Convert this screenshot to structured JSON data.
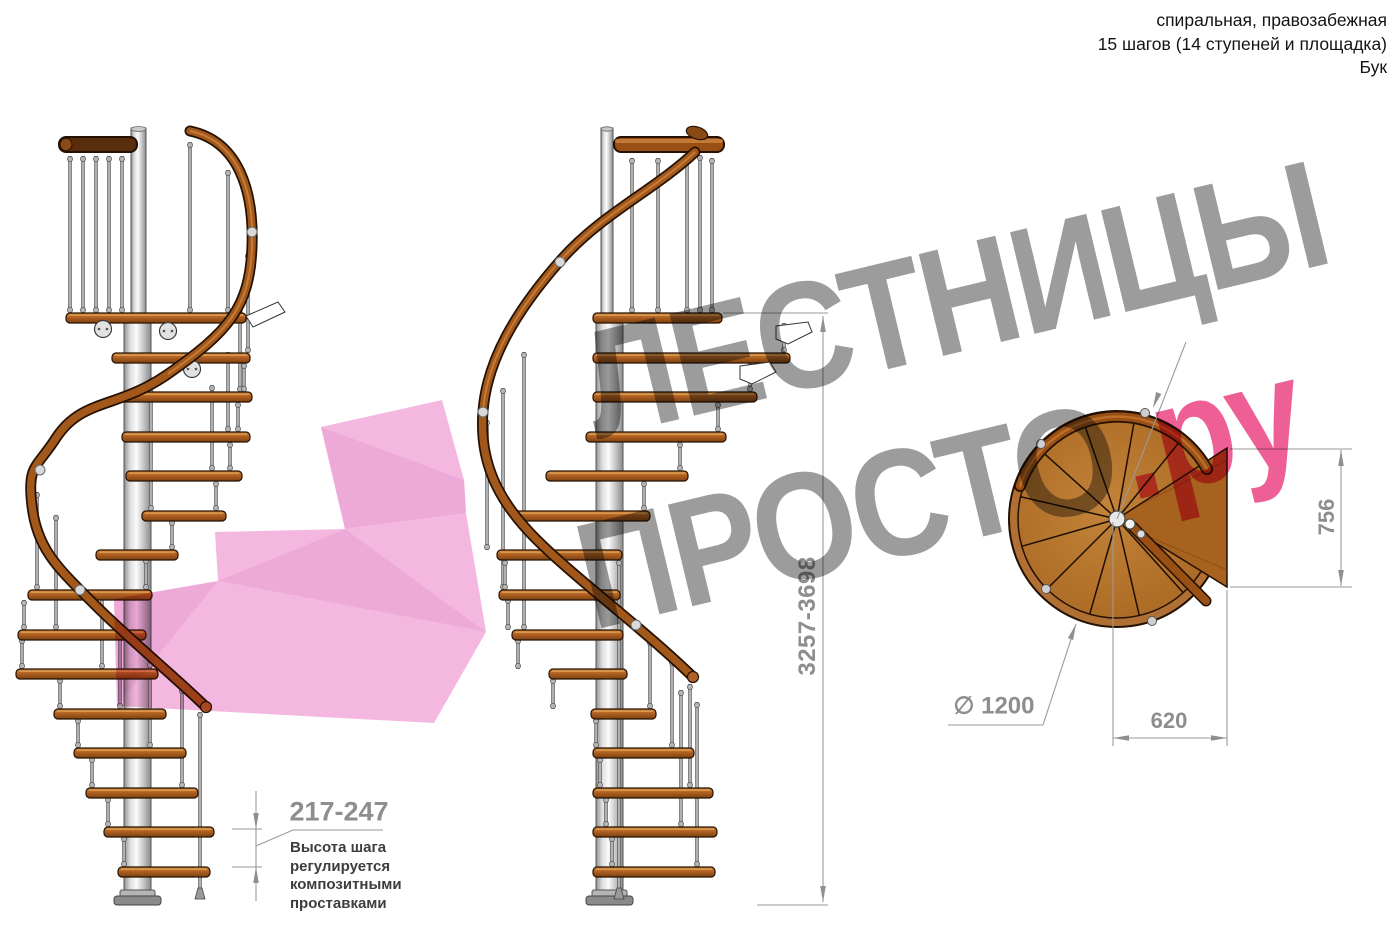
{
  "title_block": {
    "lines": [
      "спиральная, правозабежная",
      "15 шагов (14 ступеней и площадка)",
      "Бук"
    ]
  },
  "watermark": {
    "word1": "ЛЕСТНИЦЫ",
    "word2": "ПРОСТО",
    "suffix": ".ру",
    "gray_color": "#9c9c9c",
    "pink_color": "#ee5f96"
  },
  "dimensions": {
    "total_height": "3257-3698",
    "step_height": "217-247",
    "landing_depth": "756",
    "landing_width": "620",
    "diameter": "∅ 1200"
  },
  "step_note": {
    "lines": [
      "Высота шага",
      "регулируется",
      "композитными",
      "проставками"
    ]
  },
  "drawing_colors": {
    "wood": "#b06020",
    "handrail": "#9a5015",
    "pole": "#d9d9d9",
    "dimension_gray": "#8f8f8f",
    "ribbon_pink": "#f4b8e0"
  }
}
